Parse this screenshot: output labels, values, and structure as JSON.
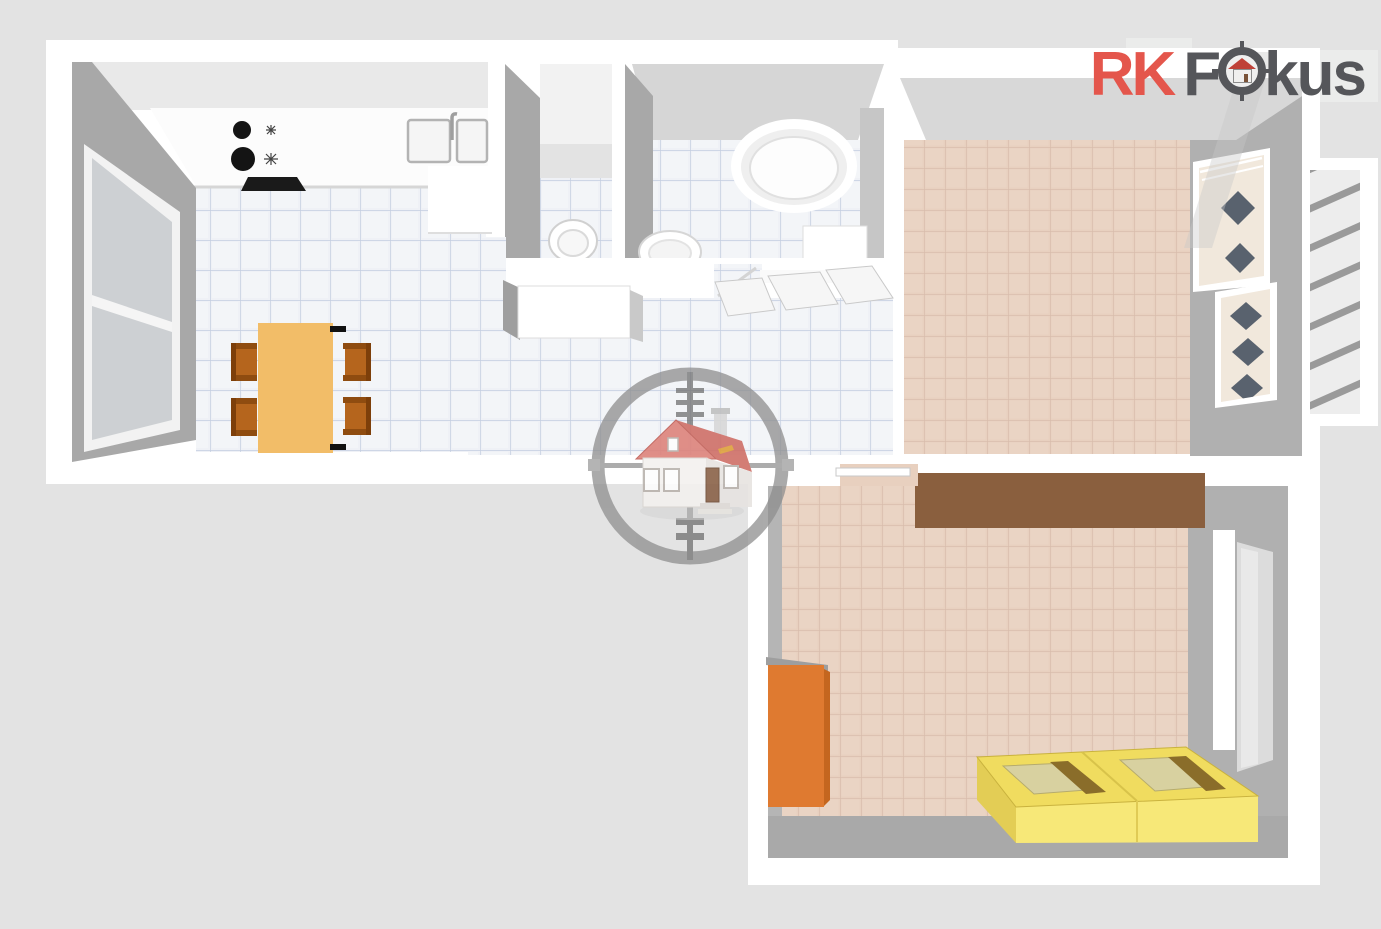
{
  "brand": {
    "prefix": "RK",
    "word_first_letter": "F",
    "word_rest": "kus",
    "full_text": "RK Fokus",
    "prefix_color": "#e4564c",
    "word_color": "#55565a"
  },
  "watermark": {
    "icon": "house-in-crosshair-icon",
    "ring_color": "#8d8d8d",
    "house_roof_color": "#dd837b",
    "house_wall_color": "#f3f1ef"
  },
  "icons": {
    "logo_o_replacement": "scope-house-icon",
    "stove": "cooktop-burners-icon",
    "sink": "double-basin-sink-icon"
  },
  "palette": {
    "background": "#e3e3e3",
    "wall_top": "#ffffff",
    "wall_shadow": "#a8a8a8",
    "wall_face_light": "#d8d8d8",
    "kitchen_floor_tile": "#eff1f6",
    "kitchen_floor_grout": "#c3cde0",
    "warm_floor_tile": "#e8d0bf",
    "warm_floor_grout": "#d7bbaa",
    "dining_table": "#f2bd68",
    "chair": "#b5651d",
    "wardrobe_brown": "#8a5f3e",
    "cabinet_orange": "#df7a30",
    "bed_yellow": "#f0dc5f",
    "bed_stripe": "#8a6d2a",
    "balcony_stripe": "#9a9a9a"
  }
}
